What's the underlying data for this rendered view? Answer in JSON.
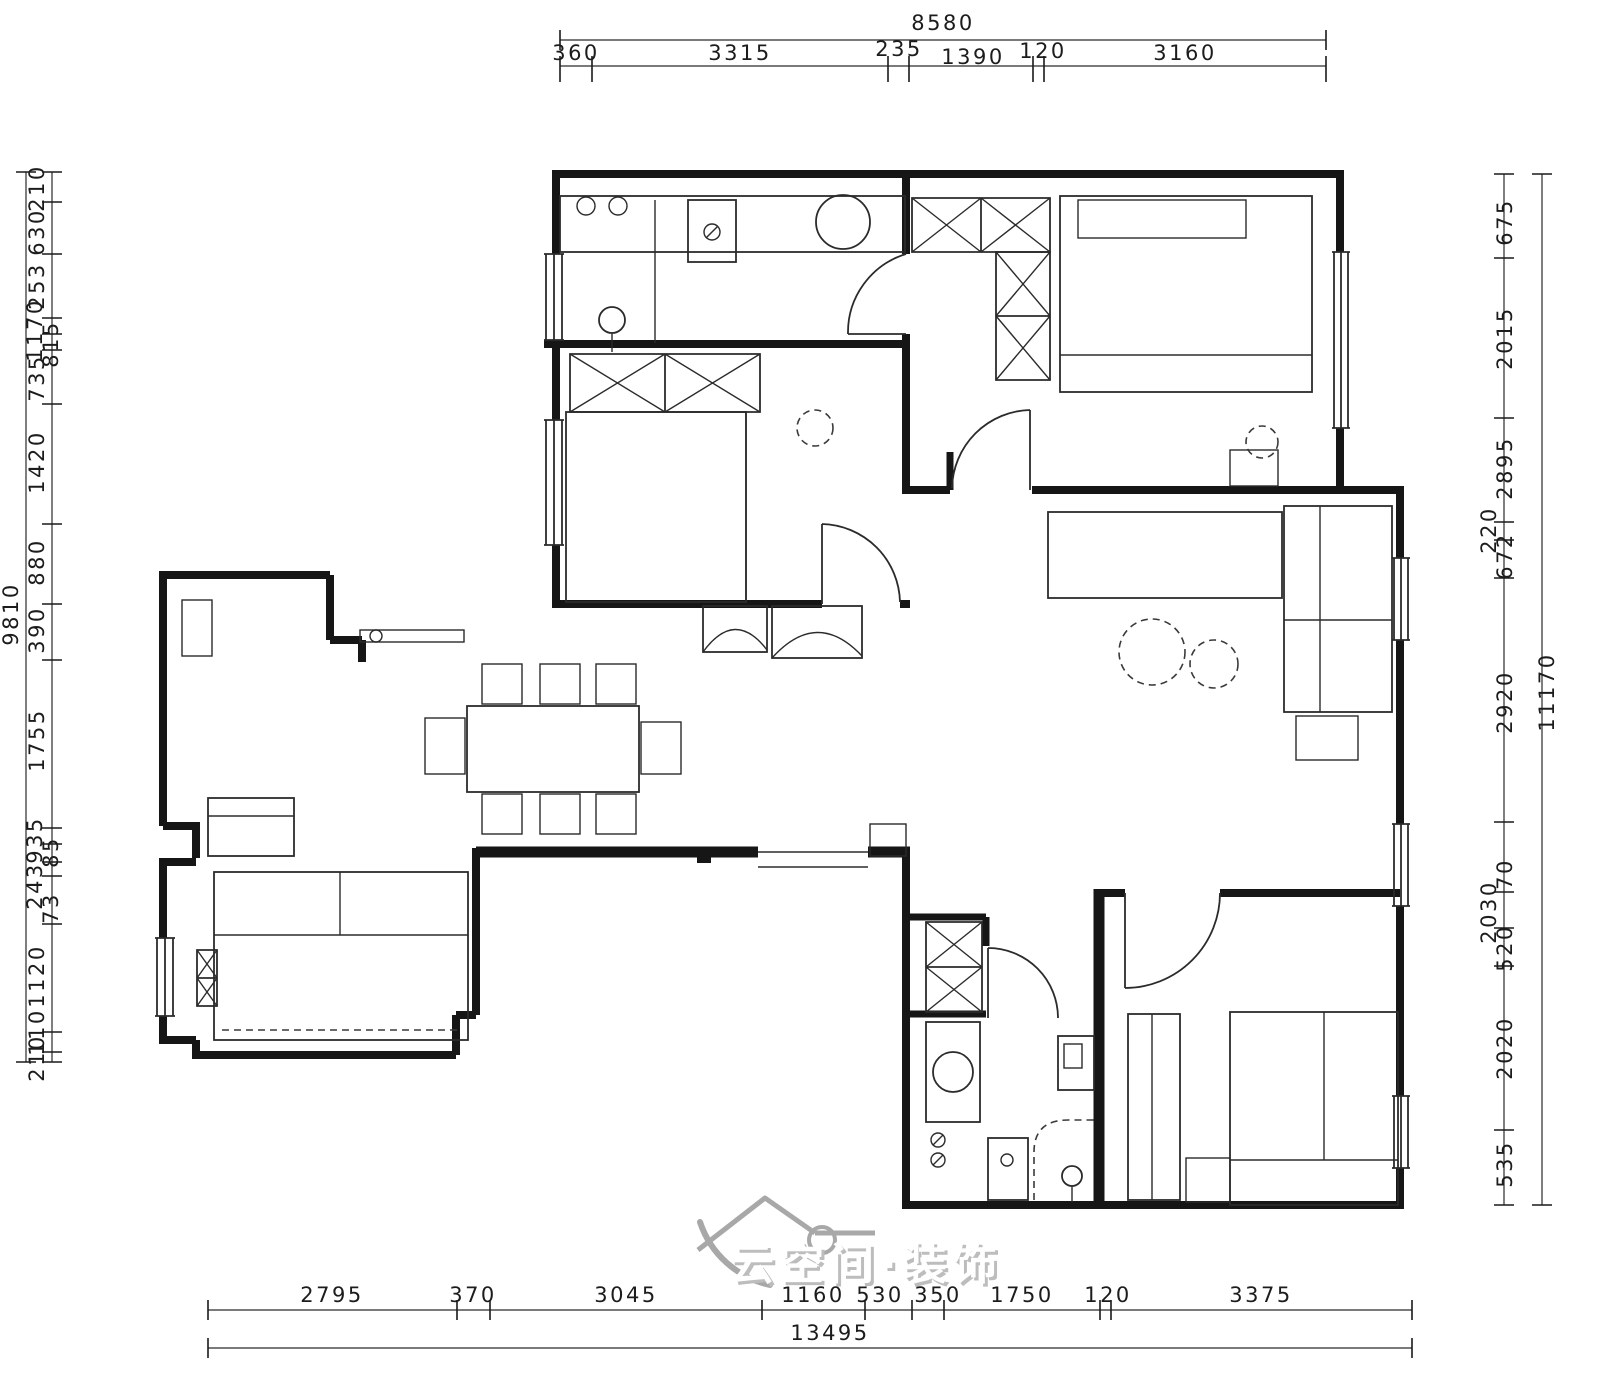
{
  "drawing": {
    "type": "residential floor plan",
    "units": "mm"
  },
  "dimensions": {
    "top": {
      "total": "8580",
      "segments": [
        "360",
        "3315",
        "235",
        "1390",
        "120",
        "3160"
      ]
    },
    "bottom": {
      "total": "13495",
      "segments": [
        "2795",
        "370",
        "3045",
        "1160",
        "530",
        "350",
        "1750",
        "120",
        "3375"
      ]
    },
    "left": {
      "total": "9810",
      "segments": [
        "210",
        "630",
        "253",
        "1170",
        "815",
        "735",
        "1420",
        "880",
        "390",
        "1755",
        "935",
        "85",
        "243",
        "73",
        "1120",
        "110",
        "210"
      ]
    },
    "right": {
      "total": "11170",
      "segments": [
        "675",
        "2015",
        "2895",
        "220",
        "672",
        "2920",
        "70",
        "2030",
        "520",
        "2020",
        "535"
      ]
    }
  },
  "watermark": {
    "text": "云空间·装饰",
    "icon": "house-roof-logo"
  },
  "colors": {
    "line": "#161616",
    "background": "#ffffff",
    "watermark": "#b9b9b9"
  }
}
